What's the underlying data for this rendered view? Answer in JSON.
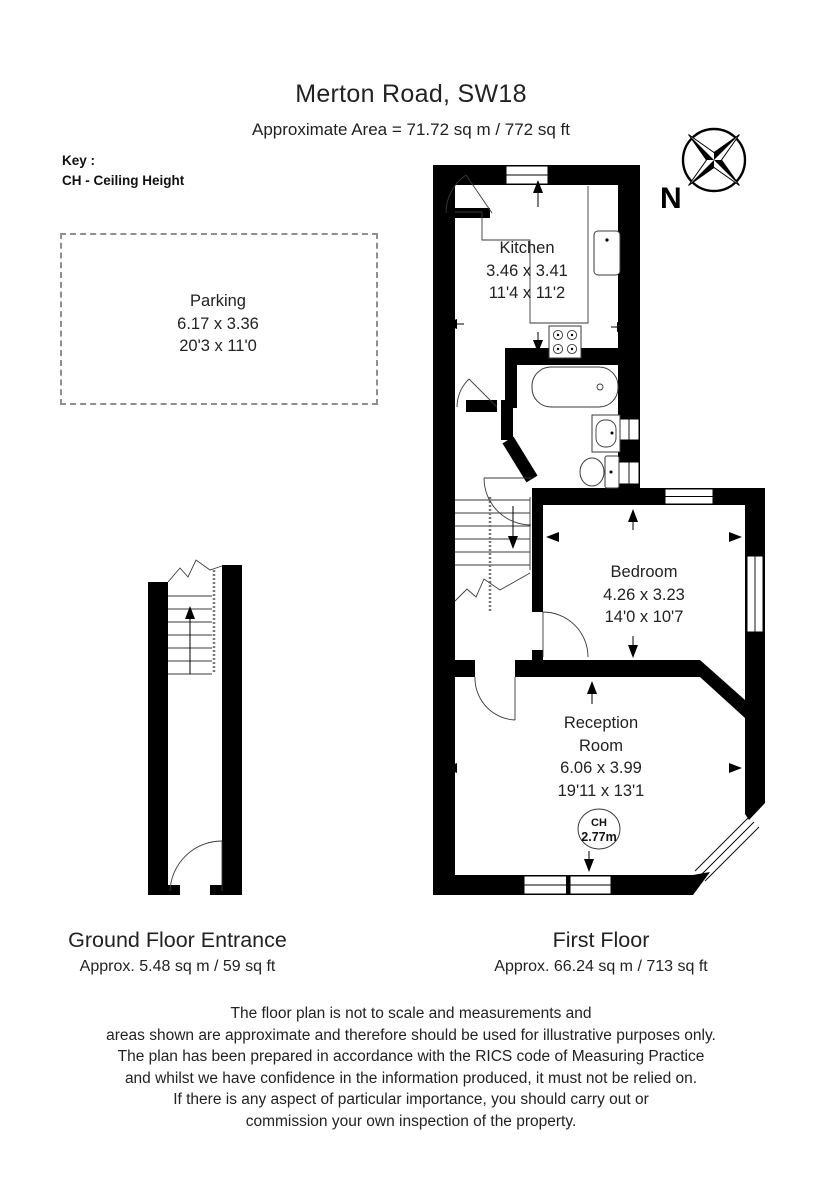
{
  "title": "Merton Road, SW18",
  "subtitle": "Approximate Area =  71.72 sq m / 772 sq ft",
  "key": {
    "heading": "Key :",
    "entry": "CH - Ceiling Height"
  },
  "compass": {
    "north_label": "N"
  },
  "parking": {
    "name": "Parking",
    "dims_metric": "6.17 x 3.36",
    "dims_imperial": "20'3 x 11'0"
  },
  "first_floor_plan": {
    "kitchen": {
      "name": "Kitchen",
      "dims_metric": "3.46 x 3.41",
      "dims_imperial": "11'4 x 11'2"
    },
    "bedroom": {
      "name": "Bedroom",
      "dims_metric": "4.26 x 3.23",
      "dims_imperial": "14'0 x 10'7"
    },
    "reception": {
      "name_line1": "Reception",
      "name_line2": "Room",
      "dims_metric": "6.06 x 3.99",
      "dims_imperial": "19'11 x 13'1"
    },
    "ceiling_height_badge": {
      "label": "CH",
      "value": "2.77m"
    }
  },
  "floor_labels": {
    "ground": {
      "title": "Ground Floor Entrance",
      "area": "Approx. 5.48 sq m / 59 sq ft"
    },
    "first": {
      "title": "First Floor",
      "area": "Approx. 66.24 sq m / 713 sq ft"
    }
  },
  "disclaimer": [
    "The floor plan is not to scale and measurements and",
    "areas shown are approximate and therefore should be used for illustrative purposes only.",
    "The plan has been prepared in accordance with the RICS code of Measuring Practice",
    "and whilst we have confidence in the information produced, it must not be relied on.",
    "If there is any aspect of particular importance, you should carry out or",
    "commission your own inspection of the property."
  ],
  "colors": {
    "wall": "#000000",
    "text": "#1b1b1b",
    "parking_border": "#8f8f8f"
  }
}
